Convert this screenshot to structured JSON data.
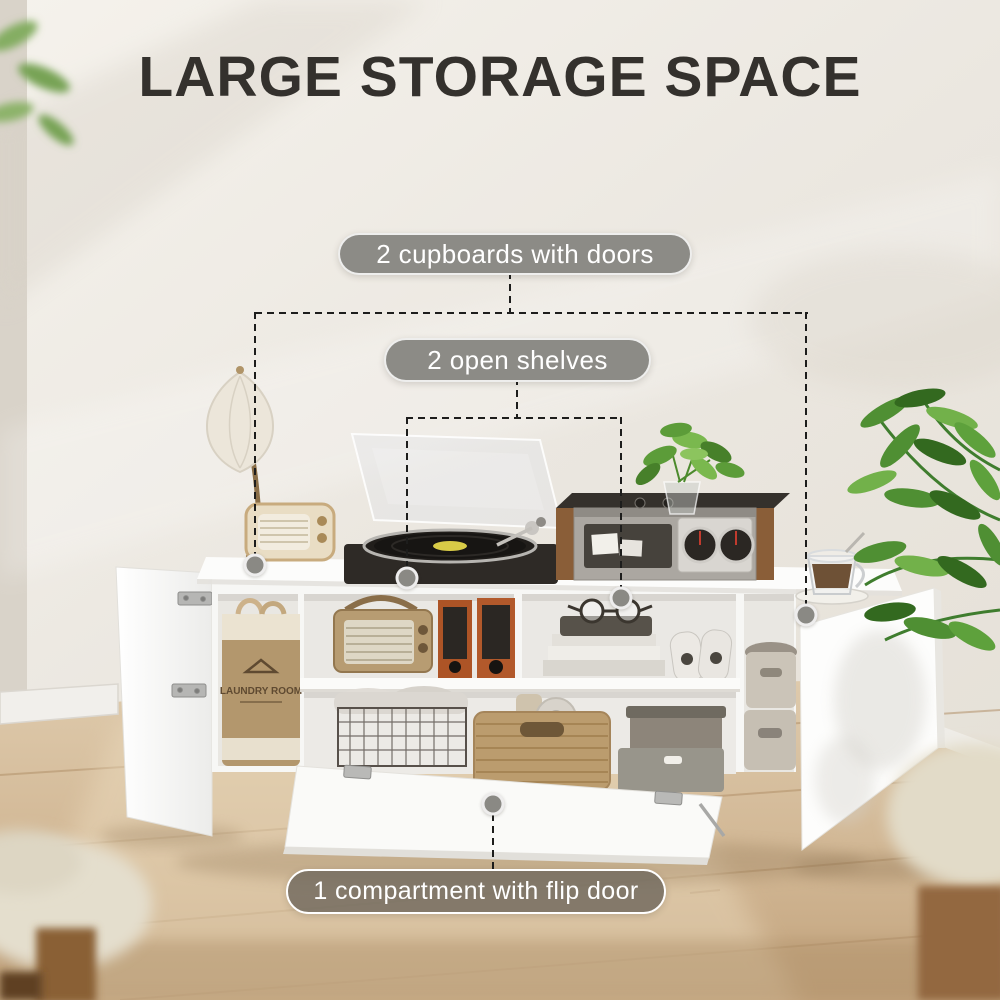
{
  "title": "LARGE STORAGE SPACE",
  "callouts": {
    "cupboards": "2 cupboards with doors",
    "shelves": "2 open shelves",
    "flip_door": "1 compartment with flip door"
  },
  "scene": {
    "laundry_bag_text": "LAUNDRY ROOM"
  },
  "colors": {
    "title_text": "#34312d",
    "pill_solid_bg": "#8c8b86",
    "pill_translucent_bg": "rgba(112,105,94,0.82)",
    "pill_text": "#ffffff",
    "connector_line": "#1d1d1c",
    "endpoint_dot": "#8a8984",
    "wall": "#ece8e1",
    "floor_wood": "#d7c1a2",
    "cabinet_white": "#f8f8f6",
    "laundry_bag": "#b3976d",
    "seagrass_basket": "#bb9c6e",
    "speaker_orange": "#b0572a",
    "plant_green": "#5c9c39"
  }
}
